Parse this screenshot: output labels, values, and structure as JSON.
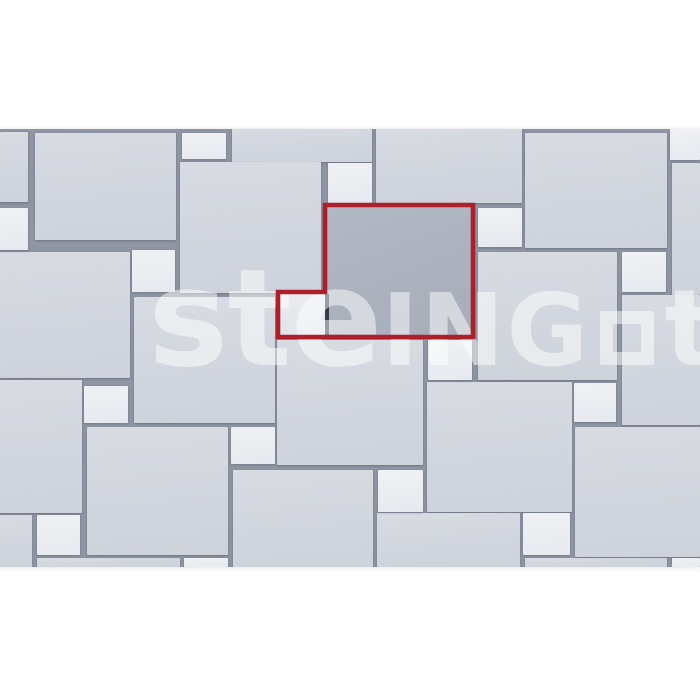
{
  "scene": {
    "top": 129,
    "height": 438,
    "joint_color": "#8f95a2"
  },
  "colors": {
    "page_background": "#ffffff",
    "large_tile": "#d2d6de",
    "small_tile": "#e9ecf0",
    "highlight_large_tile": "#abb1bd",
    "highlight_small_tile": "#e4e7ec",
    "joint": "#8f95a2",
    "inner_joint": "#343d4a",
    "module_outline_red": "#ae1f2c",
    "watermark_white": "rgba(255,255,255,0.50)"
  },
  "tiles": {
    "large": [
      [
        0,
        132,
        28,
        70
      ],
      [
        35,
        133,
        141,
        107
      ],
      [
        232,
        128,
        140,
        34
      ],
      [
        376,
        128,
        146,
        75
      ],
      [
        525,
        133,
        142,
        115
      ],
      [
        180,
        162,
        141,
        131
      ],
      [
        672,
        163,
        28,
        132
      ],
      [
        0,
        252,
        130,
        126
      ],
      [
        478,
        252,
        139,
        128
      ],
      [
        622,
        295,
        78,
        130
      ],
      [
        134,
        297,
        141,
        126
      ],
      [
        277,
        340,
        146,
        125
      ],
      [
        427,
        382,
        145,
        130
      ],
      [
        0,
        380,
        82,
        133
      ],
      [
        575,
        427,
        125,
        130
      ],
      [
        87,
        427,
        141,
        128
      ],
      [
        233,
        470,
        140,
        97
      ],
      [
        377,
        513,
        143,
        54
      ],
      [
        0,
        515,
        32,
        52
      ],
      [
        37,
        558,
        143,
        9
      ],
      [
        525,
        558,
        142,
        9
      ]
    ],
    "small": [
      [
        182,
        133,
        44,
        26
      ],
      [
        670,
        128,
        30,
        32
      ],
      [
        328,
        163,
        44,
        40
      ],
      [
        0,
        208,
        28,
        42
      ],
      [
        132,
        250,
        43,
        42
      ],
      [
        478,
        208,
        44,
        39
      ],
      [
        622,
        252,
        44,
        40
      ],
      [
        84,
        386,
        44,
        37
      ],
      [
        428,
        340,
        44,
        40
      ],
      [
        574,
        383,
        42,
        39
      ],
      [
        231,
        427,
        44,
        37
      ],
      [
        378,
        470,
        45,
        42
      ],
      [
        37,
        515,
        43,
        40
      ],
      [
        523,
        513,
        47,
        42
      ],
      [
        184,
        558,
        44,
        9
      ],
      [
        672,
        558,
        28,
        9
      ]
    ],
    "highlight_large": [
      325,
      205,
      148,
      132
    ],
    "highlight_small": [
      278,
      292,
      47,
      45
    ],
    "inner_joint": [
      325,
      294,
      4,
      42
    ]
  },
  "highlight_outline": {
    "points": [
      [
        325,
        205
      ],
      [
        473,
        205
      ],
      [
        473,
        337
      ],
      [
        278,
        337
      ],
      [
        278,
        292
      ],
      [
        325,
        292
      ]
    ],
    "stroke": "#ae1f2c",
    "stroke_width": 4.6
  },
  "watermark": {
    "part_ste": "ste",
    "part_ing": "ING",
    "square_icon": "square-outline",
    "part_t": "t",
    "left": 148,
    "top": 251
  }
}
